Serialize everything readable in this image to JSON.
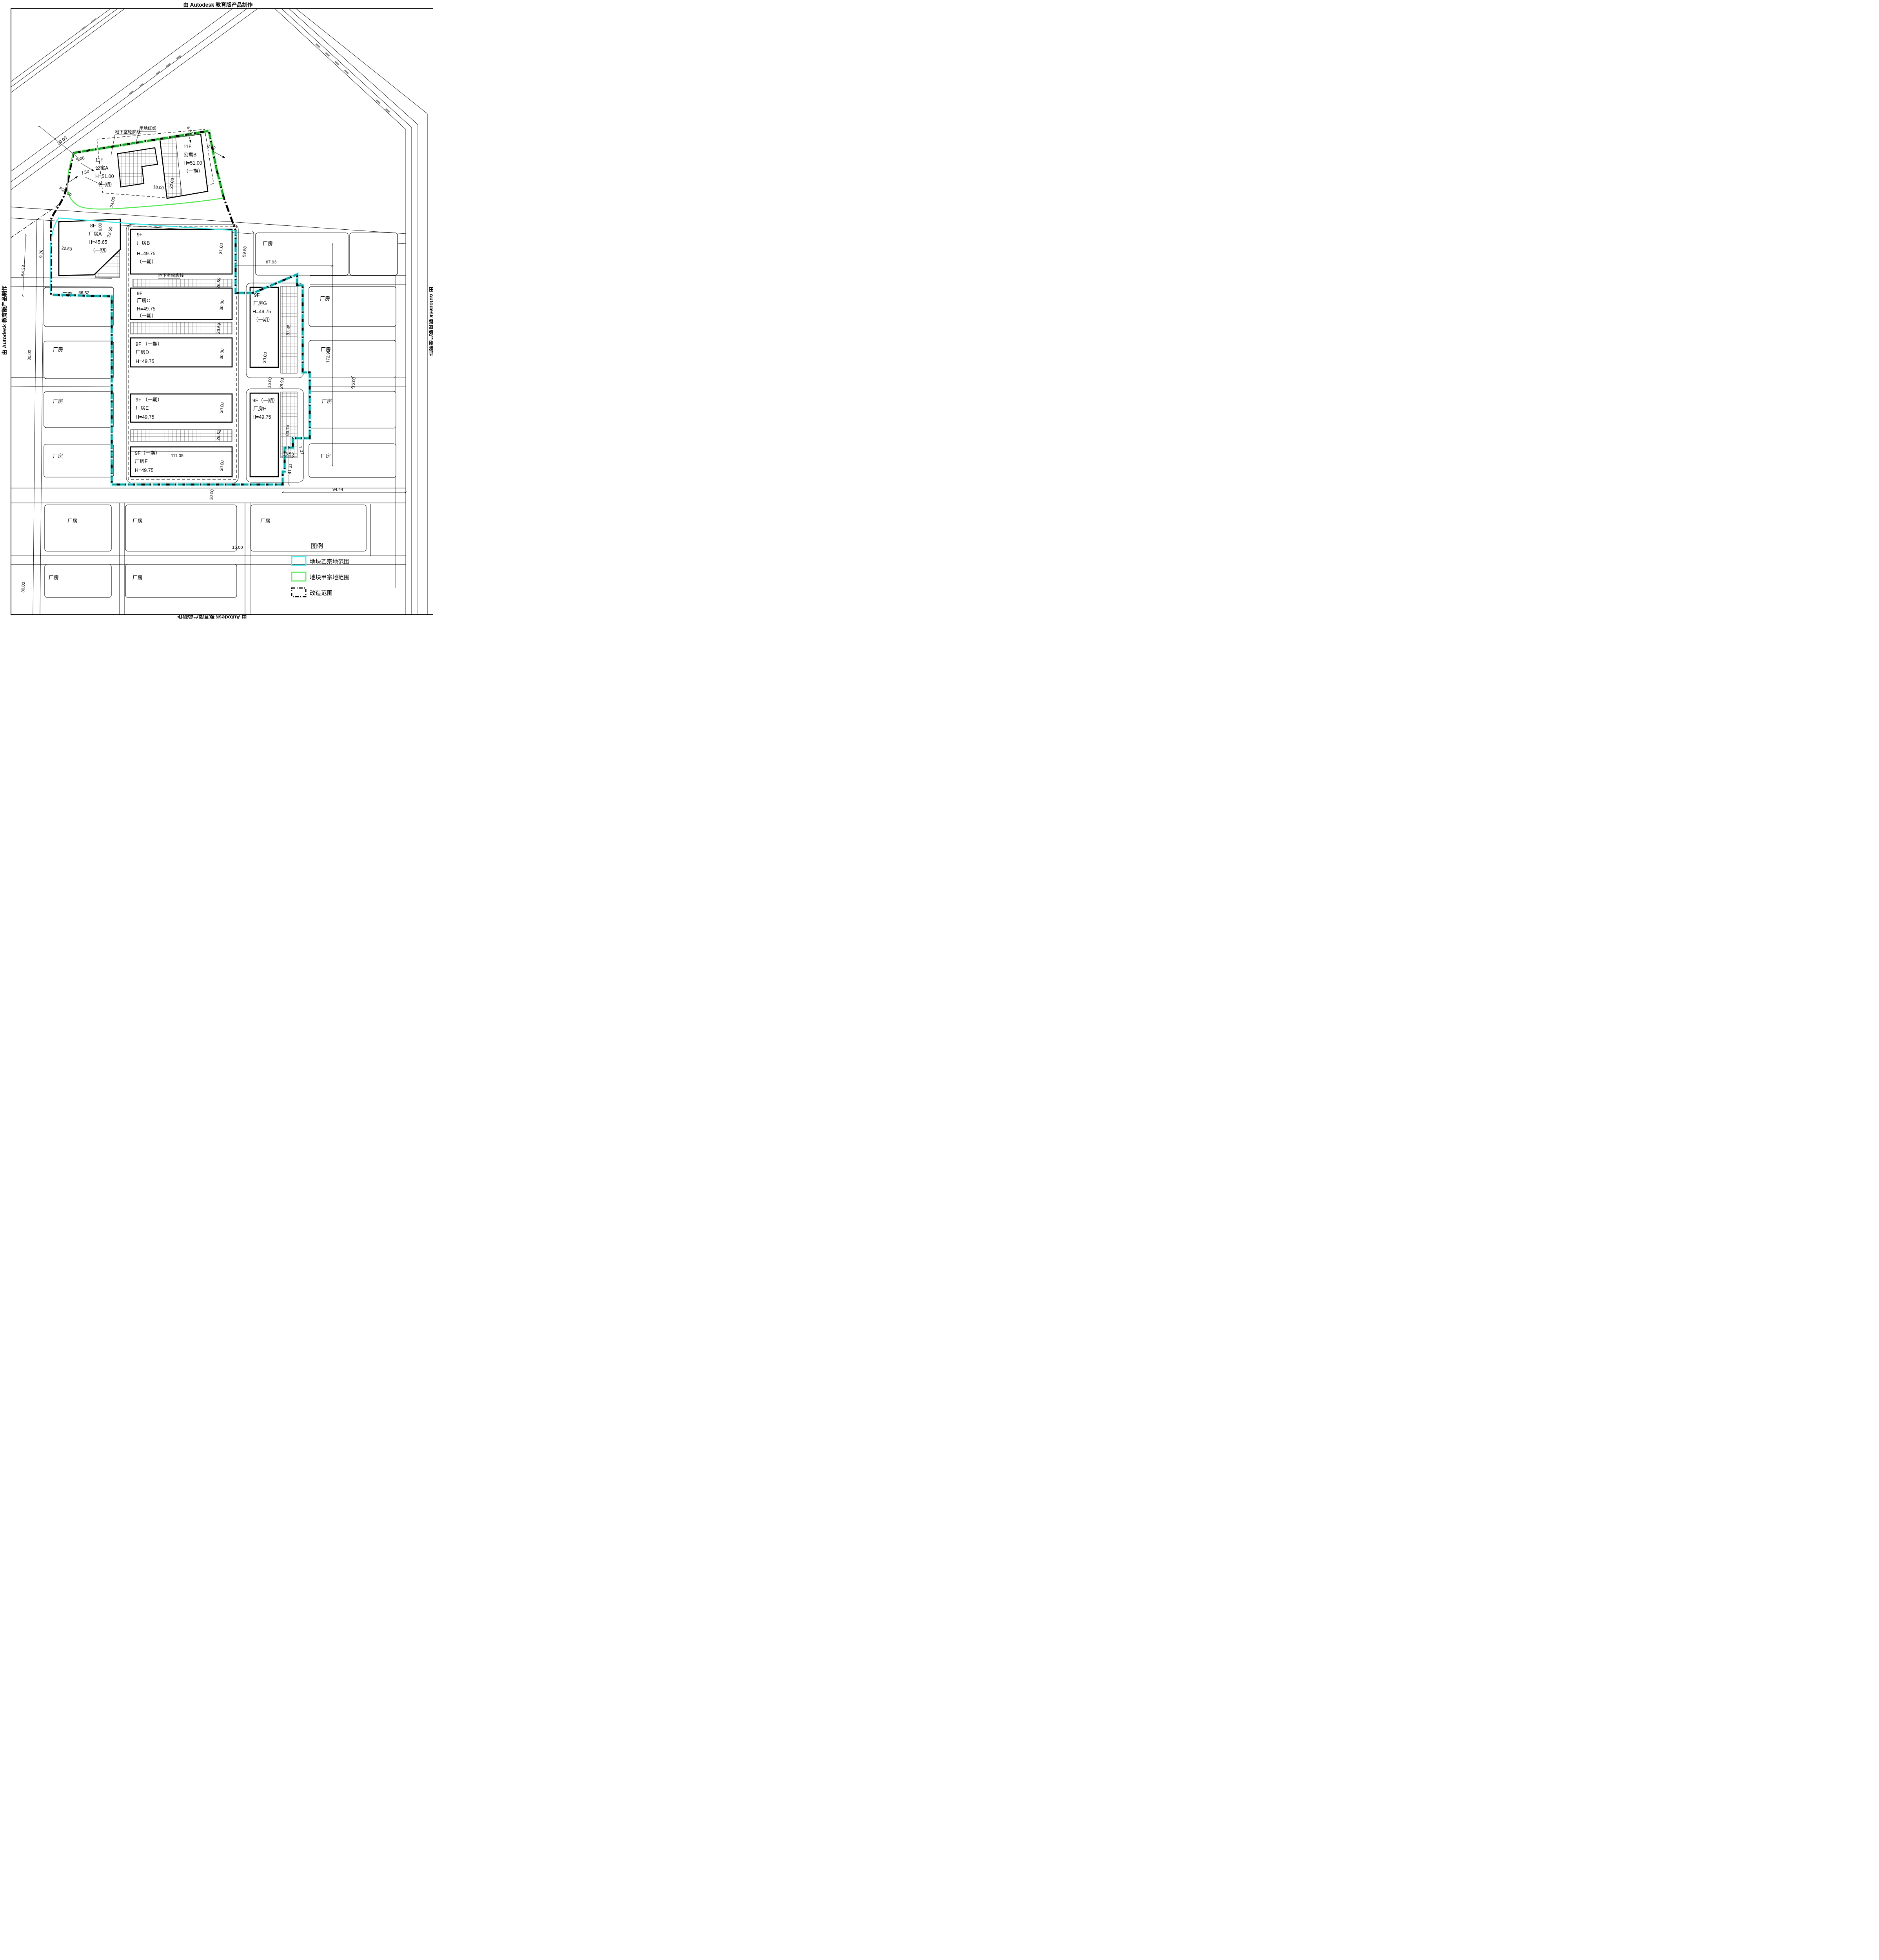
{
  "watermarks": {
    "top": "由 Autodesk 教育版产品制作",
    "left": "由 Autodesk 教育版产品制作",
    "right": "由 Autodesk 教育版产品制作",
    "bottom": "由 Autodesk 教育版产品制作"
  },
  "legend": {
    "title": "图例",
    "items": [
      {
        "label": "地块乙宗地范围",
        "color": "#4df0f0",
        "line": "solid"
      },
      {
        "label": "地块甲宗地范围",
        "color": "#6dee6d",
        "line": "solid"
      },
      {
        "label": "改造范围",
        "color": "#000000",
        "line": "dash-dot"
      }
    ]
  },
  "callouts": {
    "basement_top": "地下室轮廓线",
    "red_line": "用地红线",
    "basement_mid": "地下室轮廓线"
  },
  "buildings": {
    "apartment_a": [
      "11F",
      "公寓A",
      "H=51.00",
      "（一期）"
    ],
    "apartment_b": [
      "11F",
      "公寓B",
      "H=51.00",
      "（一期）"
    ],
    "factory_a": [
      "8F",
      "厂房A",
      "H=45.65",
      "（一期）"
    ],
    "factory_b": [
      "9F",
      "厂房B",
      "H=49.75",
      "（一期）"
    ],
    "factory_c": [
      "9F",
      "厂房C",
      "H=49.75",
      "（一期）"
    ],
    "factory_d": [
      "9F （一期）",
      "厂房D",
      "H=49.75"
    ],
    "factory_e": [
      "9F （一期）",
      "厂房E",
      "H=49.75"
    ],
    "factory_f": [
      "9F（一期）",
      "厂房F",
      "H=49.75"
    ],
    "factory_g": [
      "9F",
      "厂房G",
      "H=49.75",
      "（一期）"
    ],
    "factory_h": [
      "9F（一期）",
      "厂房H",
      "H=49.75"
    ],
    "generic_label": "厂房"
  },
  "dims": {
    "road_nw": "30.00",
    "apt_651": "6.51",
    "apt_839": "8.39",
    "apt_500": "5.00",
    "apt_750": "7.50",
    "apt_r20": "R20.00",
    "road_2400": "24.00",
    "apt_1800": "18.00",
    "apt_2200": "22.00",
    "w_5433": "54.33",
    "w_976": "9.76",
    "fa_2250v": "22.50",
    "fa_600": "6.00",
    "fa_2250h": "22.50",
    "fb_3100": "31.00",
    "ne_5988": "59.88",
    "ne_6793": "67.93",
    "strip_b_2659": "26.59",
    "strip_cd_2659": "26.59",
    "strip_ef_2652": "26.52",
    "fc_3000": "30.00",
    "fd_3000": "30.00",
    "fe_3000": "30.00",
    "ff_3000": "30.00",
    "ff_11105": "111.05",
    "fg_3000": "30.00",
    "e_1500a": "15.00",
    "e_2893": "28.93",
    "g_8745": "87.45",
    "h_8674": "86.74",
    "e_17296": "172.96",
    "e_1500b": "15.00",
    "se_727": "7.27",
    "se_1553": "15.53",
    "se_4131": "41.31",
    "s_9444": "94.44",
    "s_1500": "15.00",
    "sw_3000": "30.00",
    "w_3000": "30.00",
    "w_6652": "66.52",
    "s_3000": "30.00"
  },
  "colors": {
    "parcel_b_cyan": "#27dede",
    "parcel_a_green": "#3ddc3d",
    "boundary_black": "#000000"
  }
}
